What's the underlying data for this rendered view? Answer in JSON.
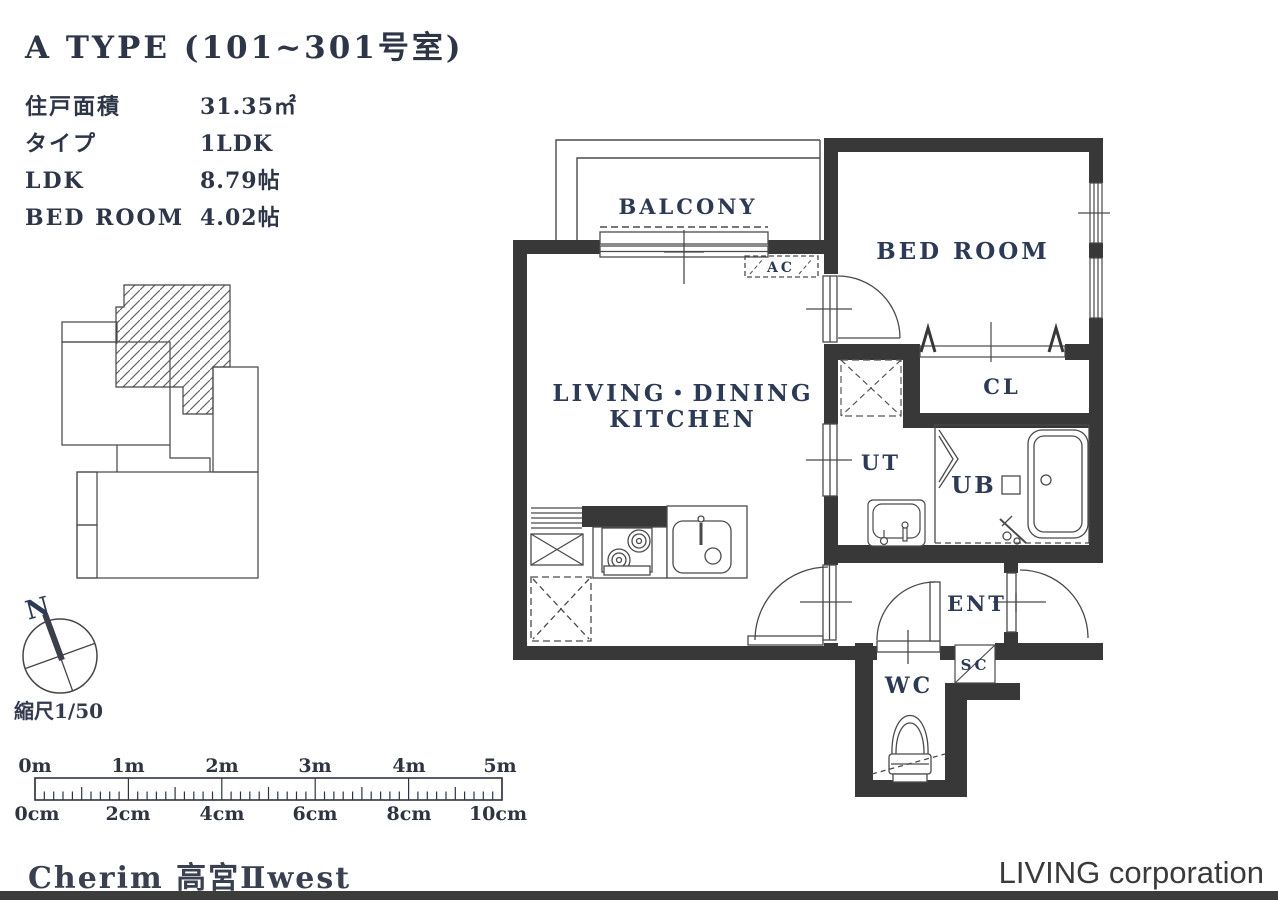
{
  "header": {
    "title": "A TYPE (101~301号室)",
    "specs": [
      {
        "label": "住戸面積",
        "value": "31.35㎡"
      },
      {
        "label": "タイプ",
        "value": "1LDK"
      },
      {
        "label": "LDK",
        "value": "8.79帖"
      },
      {
        "label": "BED ROOM",
        "value": "4.02帖"
      }
    ]
  },
  "plan": {
    "balcony": "BALCONY",
    "bed_room": "BED ROOM",
    "ldk1": "LIVING・DINING",
    "ldk2": "KITCHEN",
    "cl": "CL",
    "ut": "UT",
    "ub": "UB",
    "ent": "ENT",
    "sc": "SC",
    "wc": "WC",
    "ac": "AC"
  },
  "site": {
    "north": "N",
    "scale_note": "縮尺1/50"
  },
  "ruler": {
    "m_labels": [
      "0m",
      "1m",
      "2m",
      "3m",
      "4m",
      "5m"
    ],
    "cm_labels": [
      "0cm",
      "2cm",
      "4cm",
      "6cm",
      "8cm",
      "10cm"
    ]
  },
  "footer": {
    "building_name": "Cherim 高宮Ⅱwest",
    "company": "LIVING corporation"
  },
  "colors": {
    "wall": "#383838",
    "line": "#4a4a4a",
    "room_label": "#2c3a55",
    "footer_bar": "#3c3c3c"
  }
}
